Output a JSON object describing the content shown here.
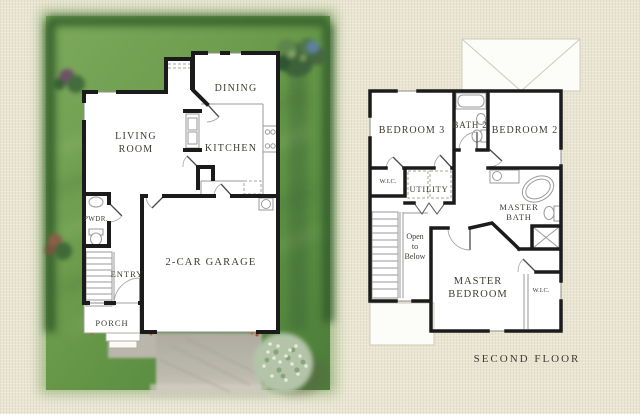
{
  "plan": {
    "first_floor": {
      "living_line1": "LIVING",
      "living_line2": "ROOM",
      "dining": "DINING",
      "kitchen": "KITCHEN",
      "powder": "PWDR.",
      "entry": "ENTRY",
      "garage": "2-CAR GARAGE",
      "porch": "PORCH"
    },
    "second_floor": {
      "floor_label": "SECOND FLOOR",
      "bedroom3": "BEDROOM 3",
      "bath2": "BATH 2",
      "bedroom2": "BEDROOM 2",
      "wic_hall": "W.I.C.",
      "utility": "UTILITY",
      "master_bath_line1": "MASTER",
      "master_bath_line2": "BATH",
      "open_line1": "Open",
      "open_line2": "to",
      "open_line3": "Below",
      "master_bedroom_line1": "MASTER",
      "master_bedroom_line2": "BEDROOM",
      "wic_master": "W.I.C."
    },
    "palette": {
      "background": "#e9e5d1",
      "lawn": "#6a9a4e",
      "hedge": "#2b5428",
      "driveway": "#b8b5ab",
      "walls": "#1b1b1b",
      "label_text": "#3f3b33",
      "roof": "#fcfcf9",
      "sage_bush": "#b3c4a8"
    }
  }
}
